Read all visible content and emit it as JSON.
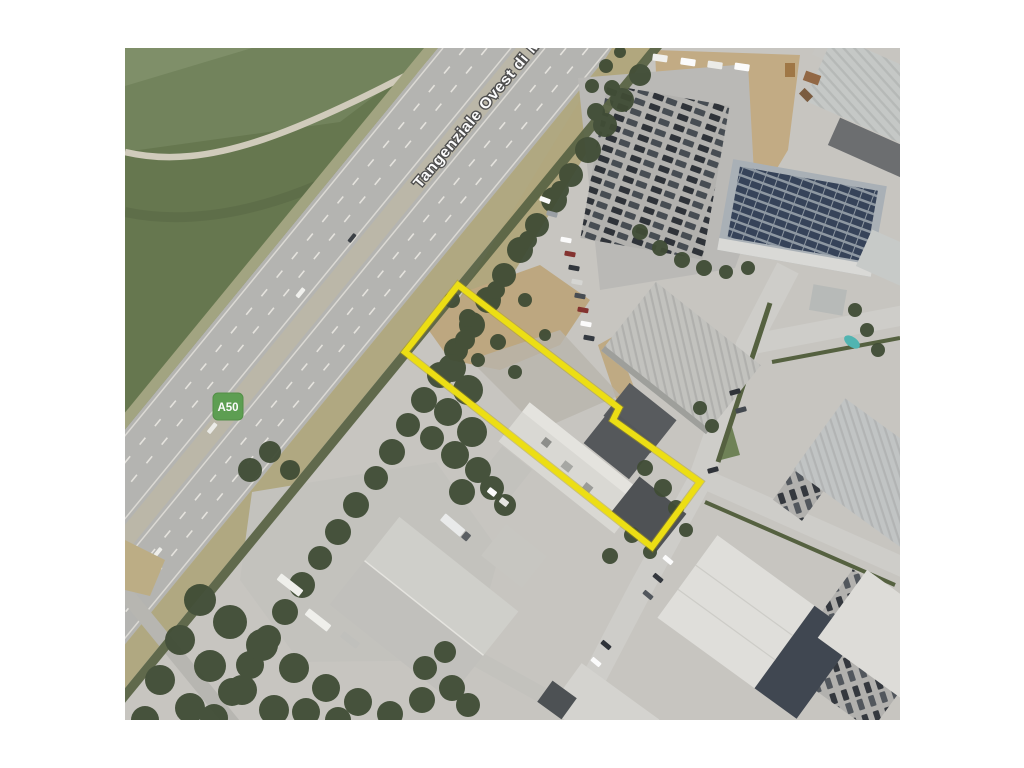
{
  "image": {
    "kind": "aerial-satellite-photo",
    "background": "#ffffff"
  },
  "map": {
    "road_label": "Tangenziale Ovest di",
    "road_label_cutoff": "M",
    "route_badge": "A50",
    "parcel_outline_points": "458,285 619,408 613,420 700,482 652,547 405,352 413,342",
    "colors": {
      "parcel_outline": "#f2e200",
      "badge_green": "#58a14b",
      "field_green": "#64774b",
      "tree_green": "#3d4b31",
      "asphalt": "#b6b6b2",
      "ground": "#c9c7c2",
      "dirt": "#c2a87d",
      "road_label_fill": "#ffffff"
    }
  }
}
